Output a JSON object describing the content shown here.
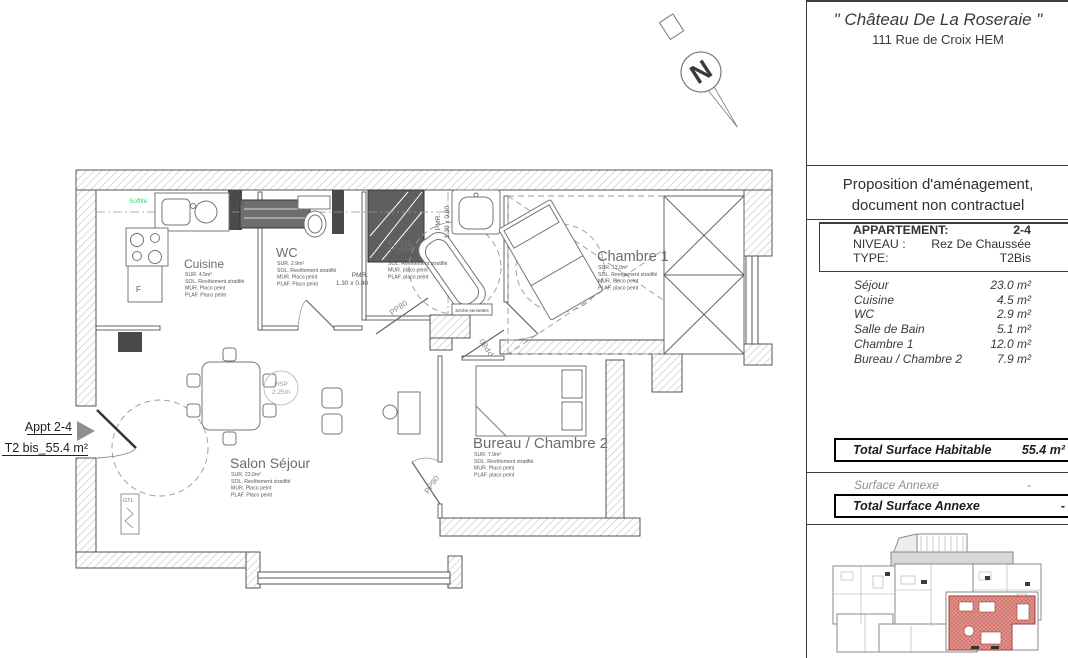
{
  "panel": {
    "building_name": "\" Château De La Roseraie \"",
    "address": "111 Rue de Croix HEM",
    "notice": [
      "Proposition d'aménagement,",
      "document non contractuel"
    ],
    "info": [
      {
        "label": "APPARTEMENT:",
        "value": "2-4"
      },
      {
        "label": "NIVEAU :",
        "value": "Rez De Chaussée"
      },
      {
        "label": "TYPE:",
        "value": "T2Bis"
      }
    ],
    "surfaces": [
      {
        "name": "Séjour",
        "area": "23.0 m²"
      },
      {
        "name": "Cuisine",
        "area": "4.5 m²"
      },
      {
        "name": "WC",
        "area": "2.9 m²"
      },
      {
        "name": "Salle de Bain",
        "area": "5.1 m²"
      },
      {
        "name": "Chambre 1",
        "area": "12.0 m²"
      },
      {
        "name": "Bureau / Chambre 2",
        "area": "7.9 m²"
      }
    ],
    "total_habitable": {
      "label": "Total Surface Habitable",
      "value": "55.4 m²"
    },
    "surface_annexe": {
      "label": "Surface Annexe",
      "value": "-"
    },
    "total_annexe": {
      "label": "Total Surface Annexe",
      "value": "-"
    }
  },
  "plan": {
    "ref": {
      "line1": "Appt 2-4",
      "line2": "T2 bis_55.4 m²"
    },
    "north_label": "N",
    "rooms": [
      {
        "name": "Cuisine",
        "lines": [
          "SUR.  4.5m²",
          "SOL.  Revêtement stratifié",
          "MUR.  Placo peint",
          "PLAF.  Placo peint"
        ]
      },
      {
        "name": "WC",
        "lines": [
          "SUR.  2.9m²",
          "SOL.  Revêtement stratifié",
          "MUR.  Placo peint",
          "PLAF.  Placo peint"
        ]
      },
      {
        "name": "SdB",
        "lines": [
          "SUR.  5.1m²",
          "SOL.  Revêtement stratifié",
          "MUR.  placo peint",
          "PLAF.  placo peint"
        ]
      },
      {
        "name": "Chambre 1",
        "lines": [
          "SUR.  12.0m²",
          "SOL.  Revêtement stratifié",
          "MUR.  Placo peint",
          "PLAF.  placo peint"
        ]
      },
      {
        "name": "Salon Séjour",
        "lines": [
          "SUR.  23.0m²",
          "SOL.  Revêtement stratifié",
          "MUR.  Placo peint",
          "PLAF.  Placo peint"
        ]
      },
      {
        "name": "Bureau / Chambre 2",
        "lines": [
          "SUR.  7.9m²",
          "SOL.  Revêtement stratifié",
          "MUR.  Placo peint",
          "PLAF.  placo peint"
        ]
      }
    ],
    "annotations": {
      "soffite": "Soffite",
      "ml": "ML",
      "fridge": "F",
      "pmr_label": "PMR.",
      "pmr_size": "1.30 x 0.80",
      "hsp_line1": "HSP",
      "hsp_line2": "2.25m",
      "gtl": "GTL",
      "towel_dryer": "Sèche-serviettes",
      "door_pp80": "PP80",
      "door_pp90": "PP90"
    }
  },
  "colors": {
    "unit_highlight": "#d98078",
    "unit_highlight_dark": "#c4574f",
    "soffit_green": "#3fce7a",
    "wall_hatch": "#bcbcbc"
  }
}
